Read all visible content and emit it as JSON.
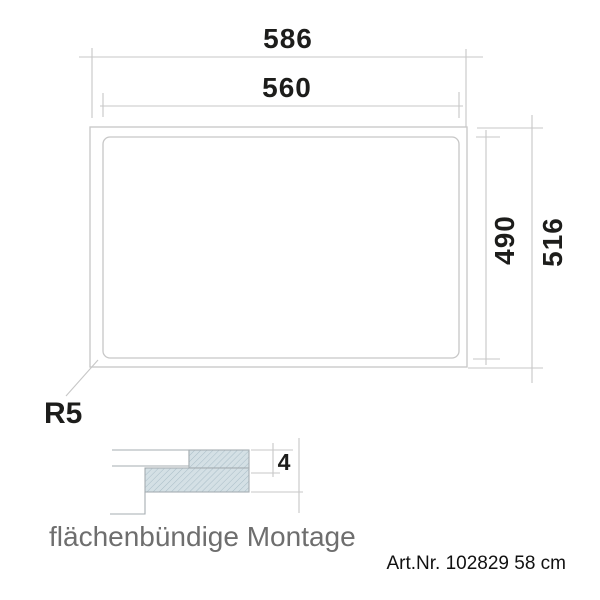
{
  "diagram": {
    "top_view": {
      "dim_outer_width": "586",
      "dim_inner_width": "560",
      "dim_inner_height": "490",
      "dim_outer_height": "516",
      "corner_radius_label": "R5"
    },
    "section_view": {
      "dim_panel_thickness": "4",
      "caption": "flächenbündige Montage"
    },
    "footer": {
      "article_number": "Art.Nr. 102829 58 cm"
    },
    "colors": {
      "drawing_line": "#c7c7c7",
      "section_line": "#a6adb2",
      "section_fill": "#d4e0e5",
      "section_hatch": "#a9bdc7",
      "dimension_text": "#1d1d1b",
      "caption_text": "#6e6e6e",
      "article_text": "#111111"
    }
  }
}
